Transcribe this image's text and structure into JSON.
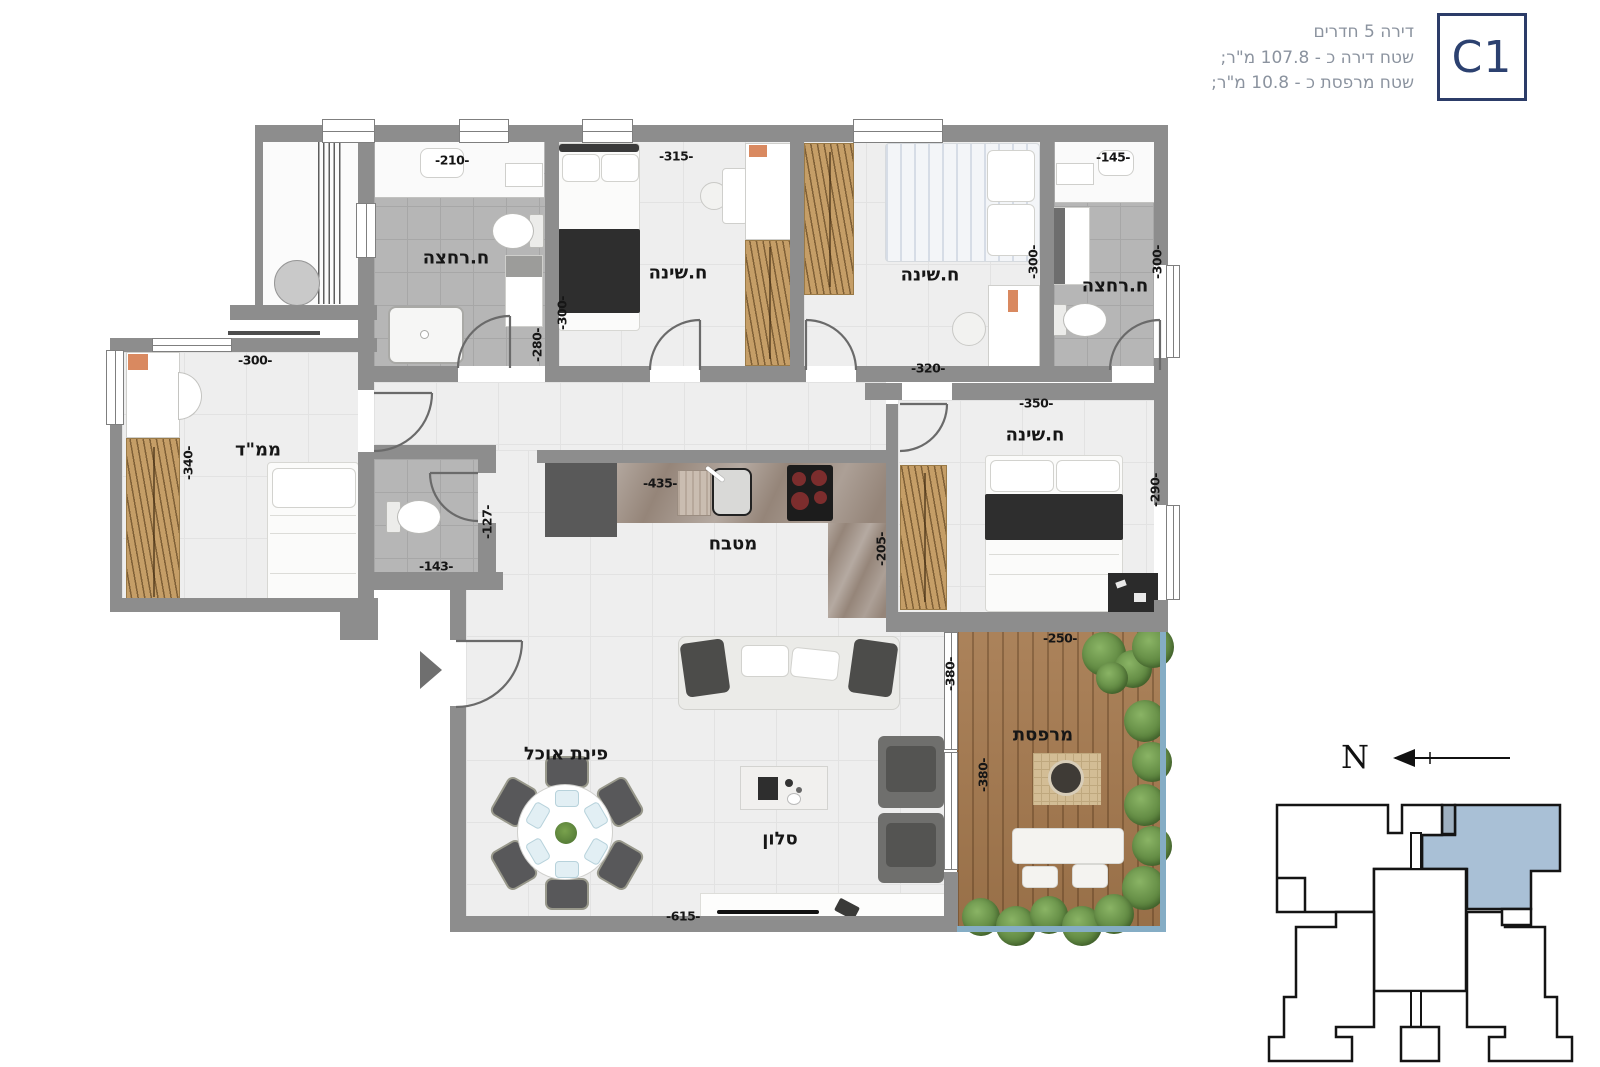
{
  "header": {
    "unit_code": "C1",
    "line1": "דירה 5 חדרים",
    "line2": "שטח דירה כ - 107.8 מ\"ר;",
    "line3": "שטח מרפסת כ - 10.8 מ\"ר;"
  },
  "plan": {
    "rooms": {
      "bath1": {
        "label": "ח.רחצה",
        "dim_w": "-210-",
        "dim_h": "-280-"
      },
      "bed1": {
        "label": "ח.שינה",
        "dim_w": "-315-",
        "dim_h": "-300-"
      },
      "bed2": {
        "label": "ח.שינה",
        "dim_w": "-320-",
        "dim_h": "-300-"
      },
      "bath2": {
        "label": "ח.רחצה",
        "dim_w": "-145-",
        "dim_h": "-300-"
      },
      "mamad": {
        "label": "ממ\"ד",
        "dim_w": "-300-",
        "dim_h": "-340-"
      },
      "wc": {
        "dim_w": "-143-",
        "dim_h": "-127-"
      },
      "kitchen": {
        "label": "מטבח",
        "dim_w": "-435-",
        "dim_h": "-205-"
      },
      "master": {
        "label": "ח.שינה",
        "dim_w": "-350-",
        "dim_h": "-290-"
      },
      "dining": {
        "label": "פינת אוכל"
      },
      "living": {
        "label": "סלון",
        "dim_w": "-615-",
        "dim_h": "-380-"
      },
      "balcony": {
        "label": "מרפסת",
        "dim_w": "-250-",
        "dim_h": "-380-"
      }
    }
  },
  "compass": {
    "label": "N"
  },
  "colors": {
    "wall_gray": "#8d8d8d",
    "keyplan_unit_blue": "#a9c0d6",
    "brand_navy": "#2c3c68",
    "wood": "#c59e67",
    "deck": "#a5794e"
  }
}
